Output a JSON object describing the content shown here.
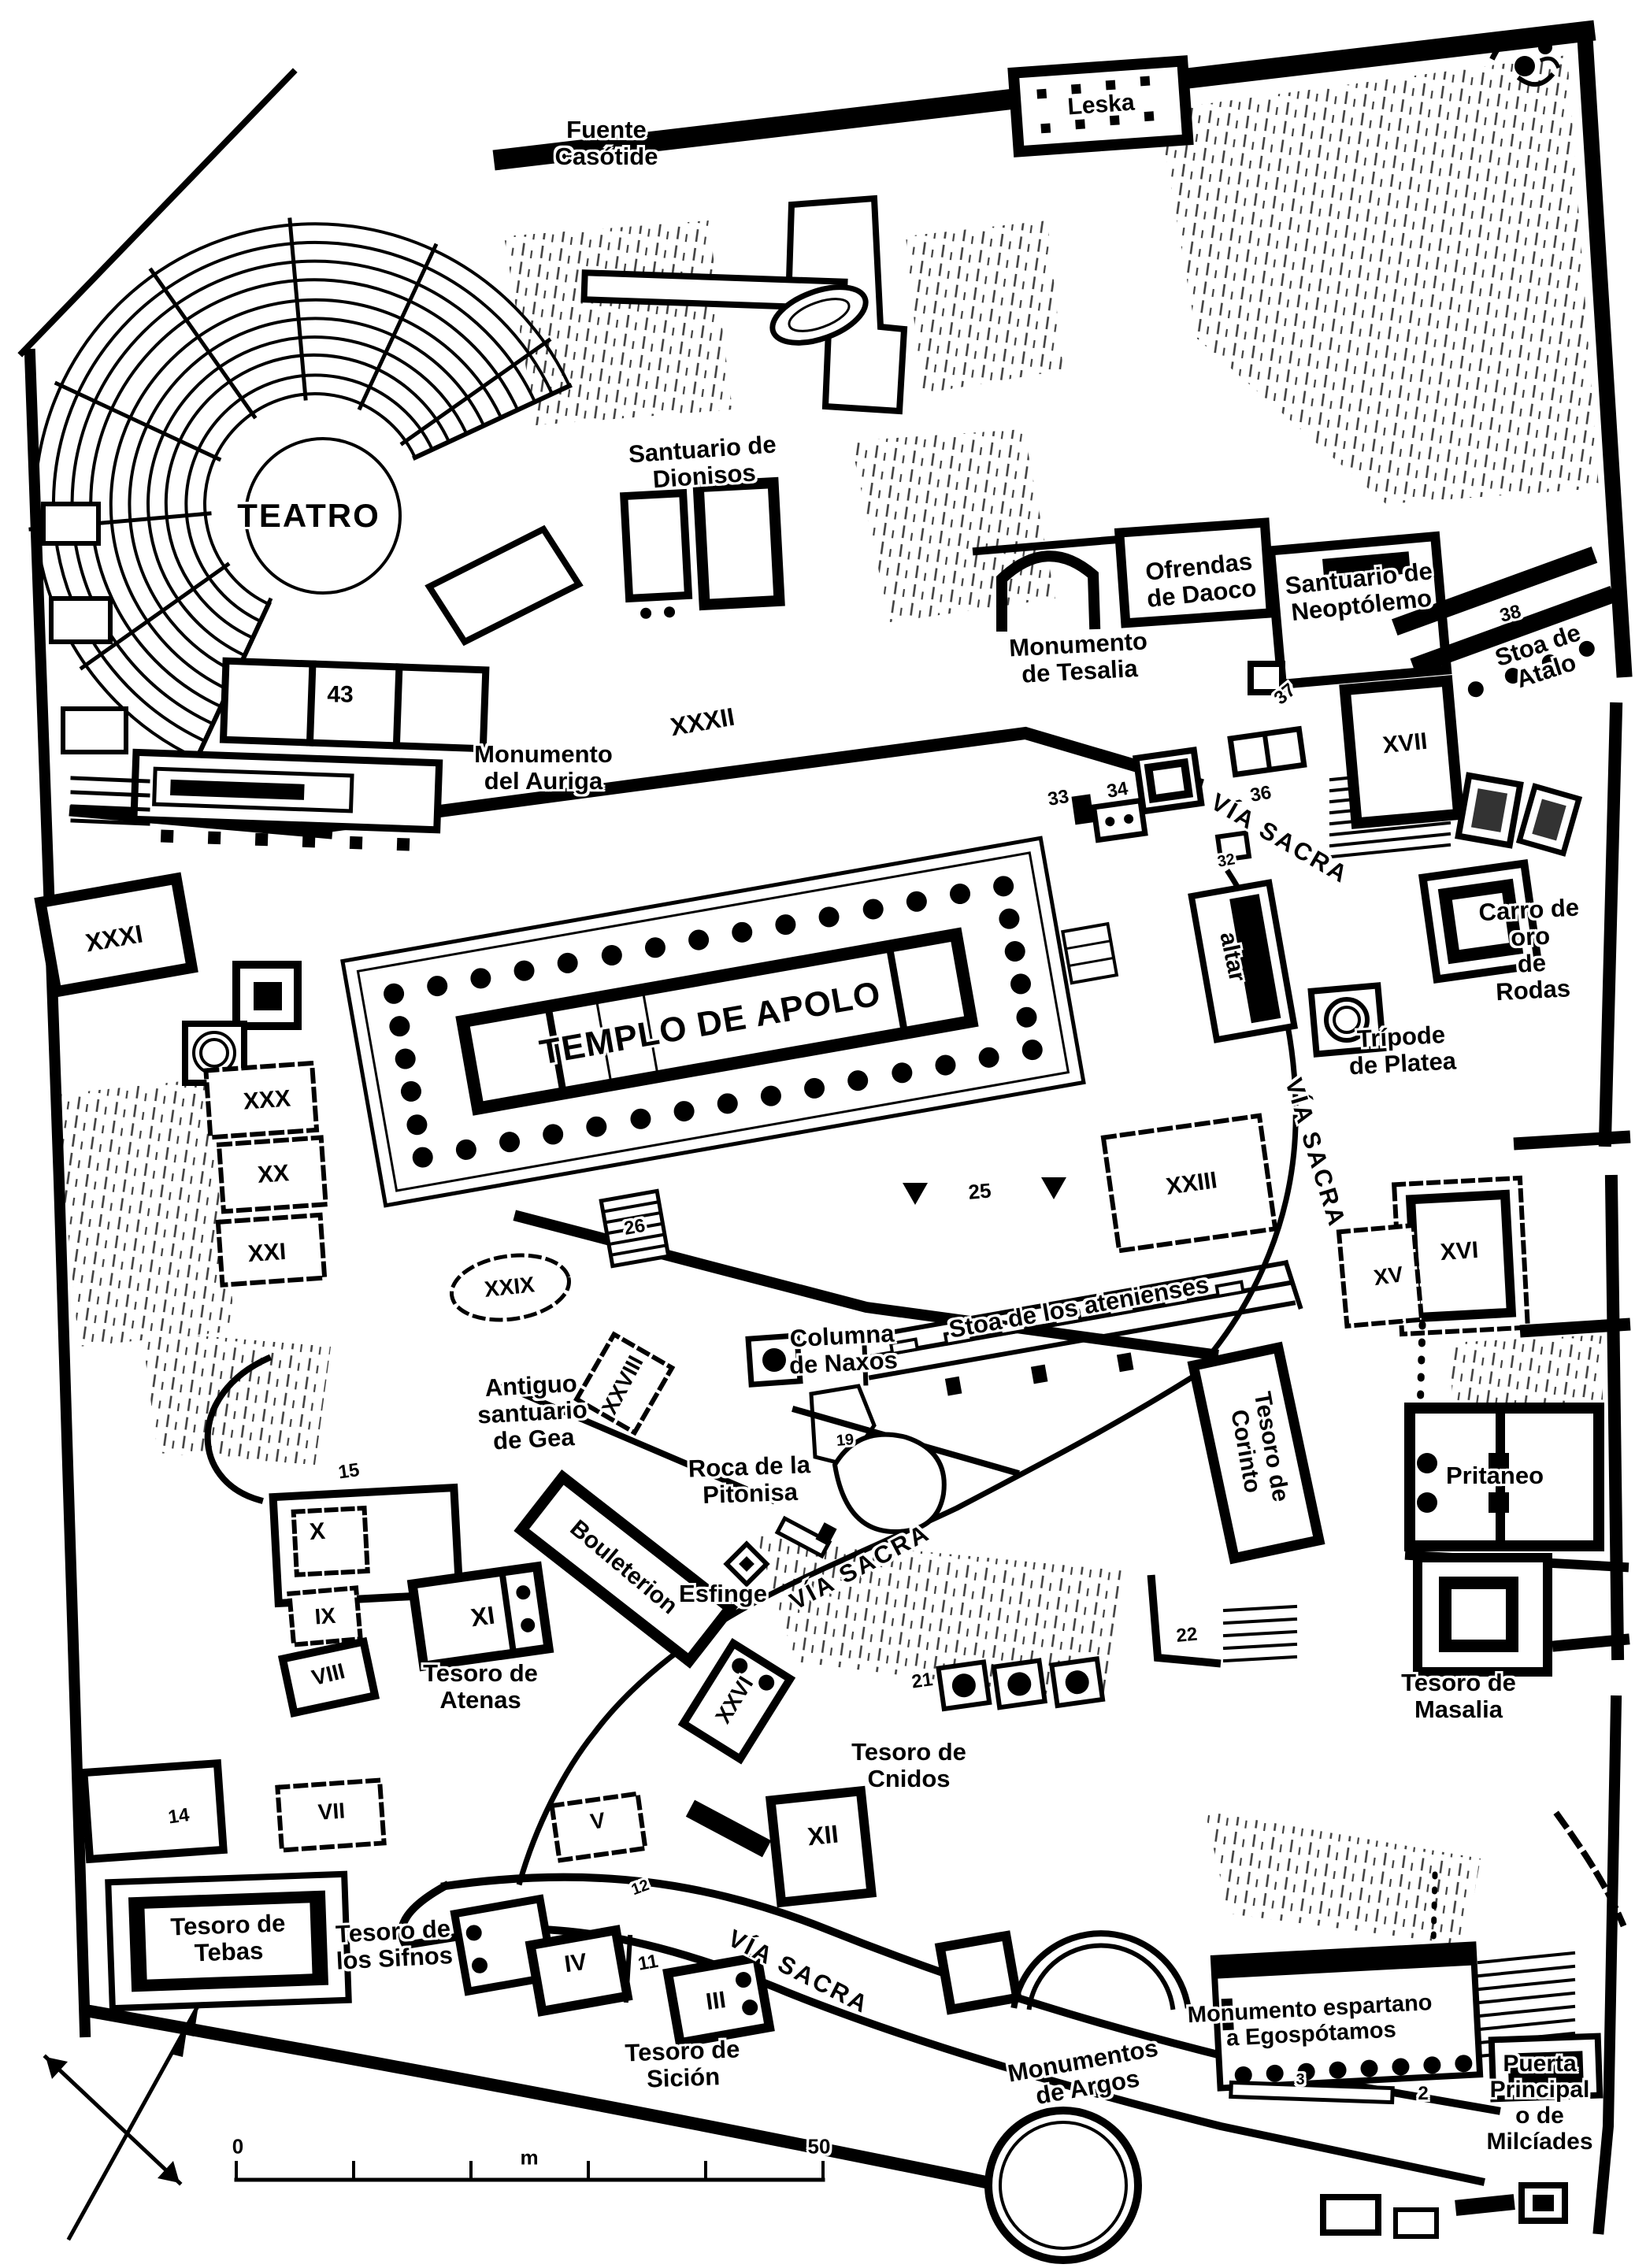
{
  "page": {
    "paper_color": "#ffffff",
    "ink_color": "#000000"
  },
  "labels": {
    "fuente_casotide": "Fuente\nCasótide",
    "leska": "Leska",
    "teatro": "TEATRO",
    "santuario_dionisos": "Santuario de\nDionisos",
    "ofrendas_daoco": "Ofrendas\nde Daoco",
    "santuario_neoptolemo": "Santuario de\nNeoptólemo",
    "monumento_tesalia": "Monumento\nde Tesalia",
    "stoa_atalo": "Stoa de\nAtalo",
    "monumento_auriga": "Monumento\ndel Auriga",
    "via_sacra": "VÍA SACRA",
    "templo_apolo": "TEMPLO DE APOLO",
    "carro_oro": "Carro de oro\nde Rodas",
    "tripode_platea": "Trípode\nde Platea",
    "altar": "altar",
    "stoa_atenienses": "Stoa de los atenienses",
    "columna_naxos": "Columna\nde Naxos",
    "antiguo_gea": "Antiguo\nsantuario\nde Gea",
    "roca_pitonisa": "Roca de la\nPitonisa",
    "tesoro_corinto": "Tesoro de\nCorinto",
    "pritaneo": "Pritaneo",
    "bouleterion": "Bouleterion",
    "esfinge": "Esfinge",
    "tesoro_atenas": "Tesoro de\nAtenas",
    "tesoro_masalia": "Tesoro de\nMasalia",
    "tesoro_cnidos": "Tesoro de\nCnidos",
    "tesoro_tebas": "Tesoro de\nTebas",
    "tesoro_sifnos": "Tesoro de\nlos Sifnos",
    "tesoro_sicion": "Tesoro de\nSición",
    "monumentos_argos": "Monumentos\nde Argos",
    "monumento_espartano": "Monumento espartano\na Egospótamos",
    "puerta_principal": "Puerta Principal\no de Milcíades"
  },
  "numerals": {
    "n43": "43",
    "n38": "38",
    "n37": "37",
    "n36": "36",
    "n34": "34",
    "n33": "33",
    "n32": "32",
    "n26": "26",
    "n25": "25",
    "n22": "22",
    "n21": "21",
    "n19": "19",
    "n15": "15",
    "n14": "14",
    "n12": "12",
    "n11": "11",
    "n3": "3",
    "n2": "2",
    "xxxii": "XXXII",
    "xxxi": "XXXI",
    "xxx": "XXX",
    "xxix": "XXIX",
    "xxviii": "XXVIII",
    "xxvi": "XXVI",
    "xxiii": "XXIII",
    "xxi": "XXI",
    "xx": "XX",
    "xvii": "XVII",
    "xvi": "XVI",
    "xv": "XV",
    "xii": "XII",
    "xi": "XI",
    "x": "X",
    "ix": "IX",
    "viii": "VIII",
    "vii": "VII",
    "v": "V",
    "iv": "IV",
    "iii": "III"
  },
  "scale_bar": {
    "zero": "0",
    "unit": "m",
    "end": "50"
  },
  "icons": {
    "compass": "compass-rose-crossed-arrows",
    "north_ornament": "decorative-flourish",
    "triangle_marker": "filled-down-triangle"
  }
}
